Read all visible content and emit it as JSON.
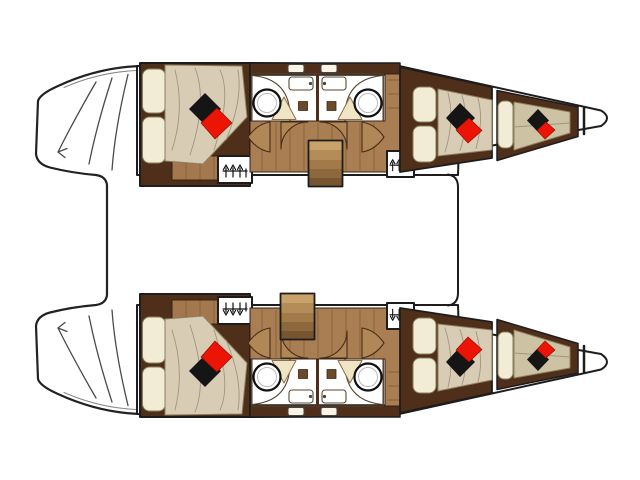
{
  "meta": {
    "title": "Catamaran sailing yacht interior deck layout plan",
    "view": "top-down floor plan",
    "bow_direction": "right",
    "stern_direction": "left"
  },
  "colors": {
    "background": "#ffffff",
    "outline": "#1d1d1d",
    "deck_white": "#ffffff",
    "dark_wood": "#4f2e1a",
    "mid_wood": "#a3784e",
    "corridor_wood": "#a87e52",
    "door_wood": "#b08756",
    "bathroom_floor": "#f3ead0",
    "counter_white": "#f9f4e4",
    "shower_tray": "#efe5c6",
    "shower_square": "#6b4a2a",
    "fixture_white": "#ffffff",
    "duvet_beige": "#d8ccb4",
    "pillow_cream": "#f2ecd6",
    "mattress_tan": "#cec2a4",
    "pillow_red": "#ec1505",
    "pillow_black": "#151515",
    "stairs": [
      "#c9a269",
      "#b48c59",
      "#a27a4a",
      "#8d683d",
      "#775531"
    ]
  },
  "layout": {
    "hulls": [
      {
        "name": "upper hull",
        "rooms": [
          "aft double cabin",
          "aft bathroom",
          "forward bathroom",
          "companionway stairs",
          "forward double cabin",
          "forepeak berth"
        ],
        "wardrobes": 2
      },
      {
        "name": "lower hull",
        "rooms": [
          "aft double cabin",
          "aft bathroom",
          "forward bathroom",
          "companionway stairs",
          "forward double cabin",
          "forepeak berth"
        ],
        "wardrobes": 2
      }
    ],
    "totals": {
      "double_cabins": 4,
      "forepeak_berths": 2,
      "bathrooms": 4,
      "washbasins": 4,
      "vanity_sinks": 4,
      "showers": 4,
      "wardrobes": 4,
      "staircases": 2
    },
    "stern_platform": "transom boarding steps with direction arrow on each hull",
    "foredeck": "forward crossbeam line between bows"
  },
  "icons": {
    "wardrobe": "clothes-hanger-icon",
    "transom": "boarding-arrow-icon"
  }
}
